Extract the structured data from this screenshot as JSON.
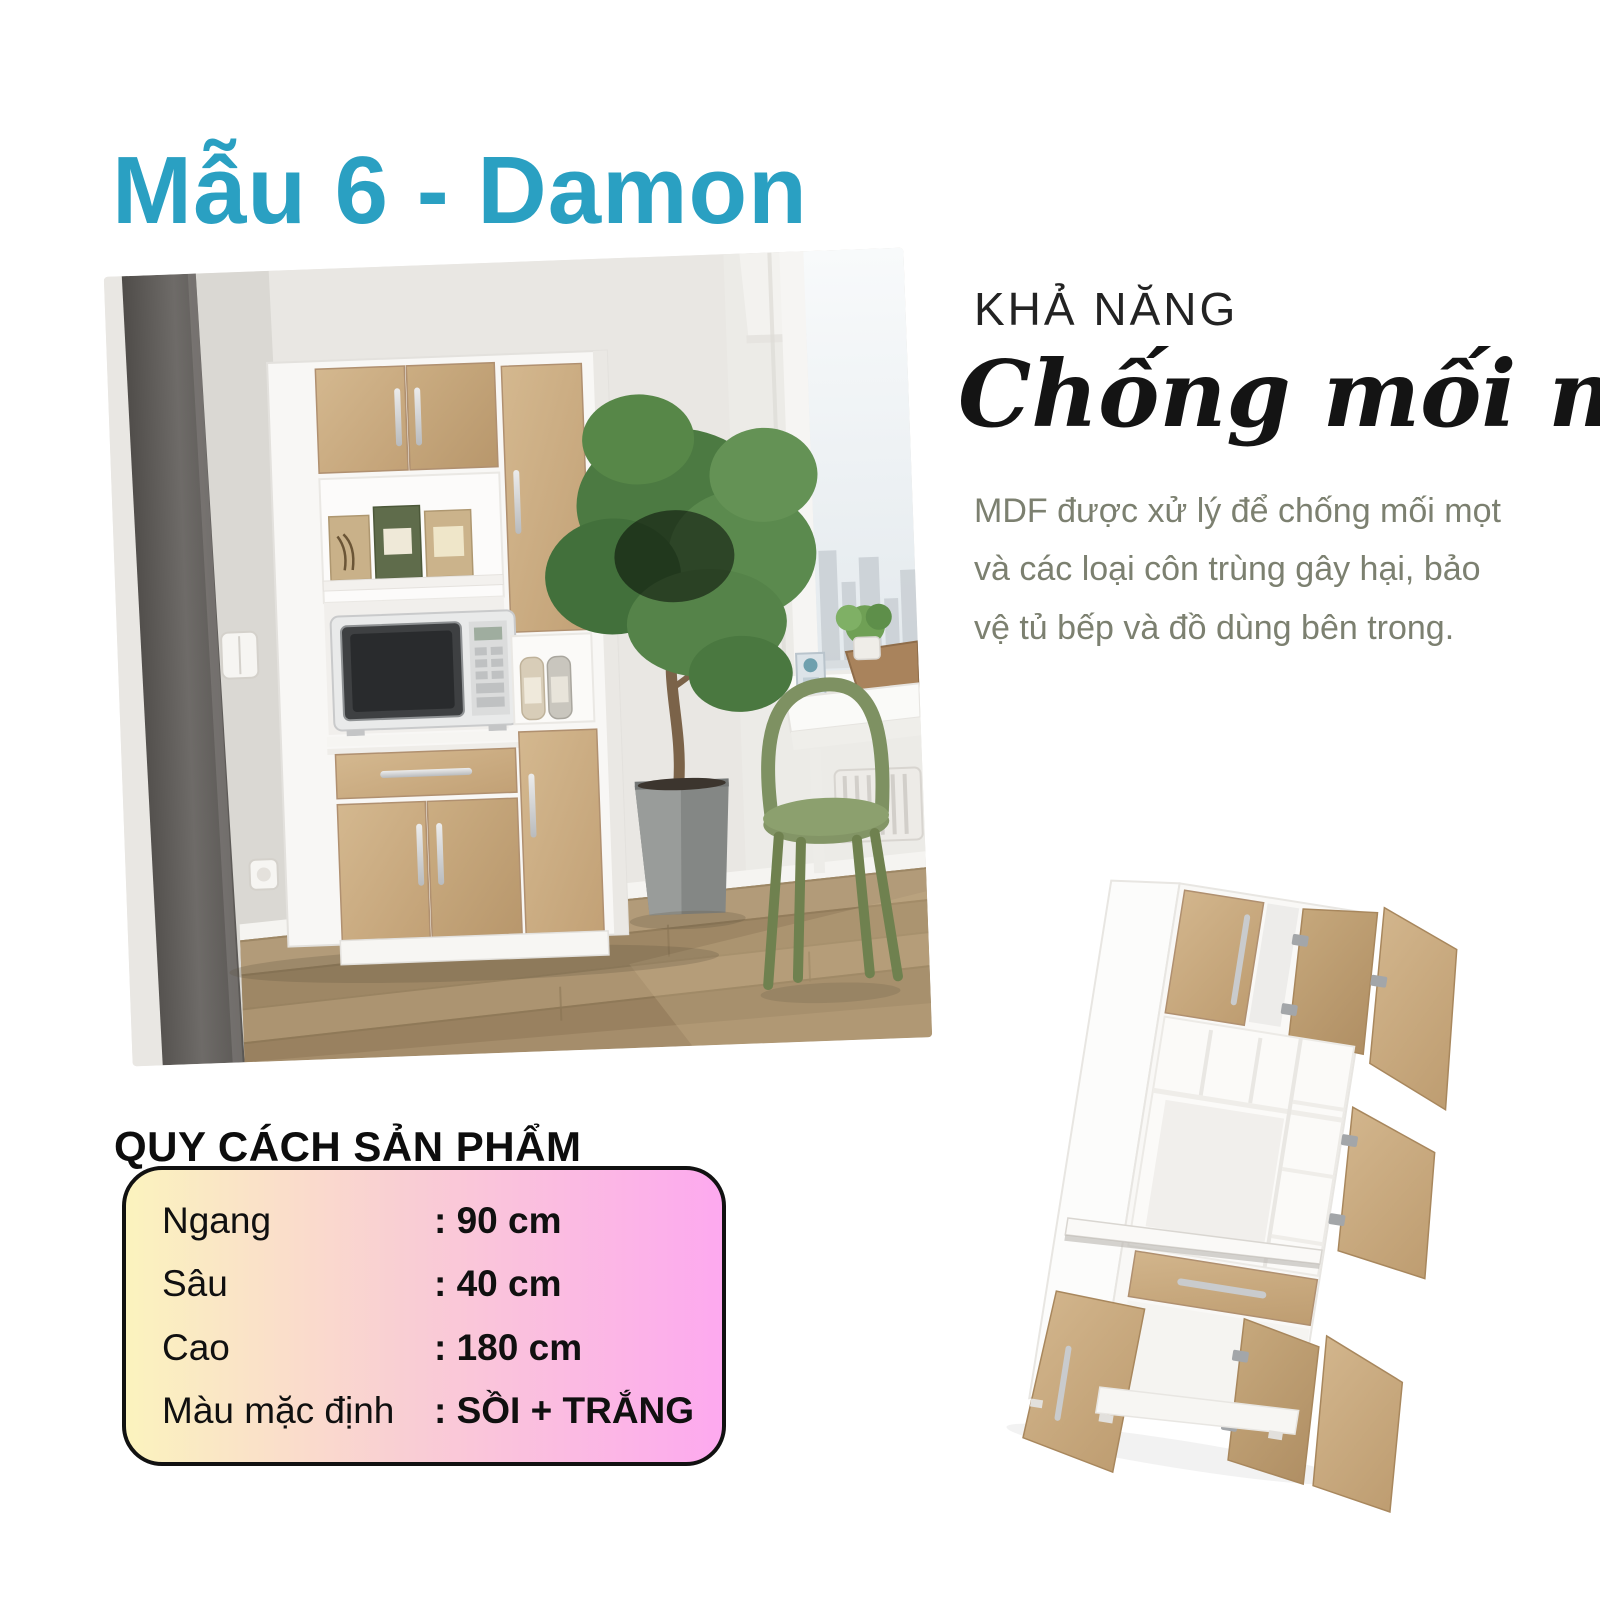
{
  "title": "Mẫu 6 - Damon",
  "feature": {
    "kicker": "KHẢ NĂNG",
    "headline": "Chống mối mọt",
    "body": "MDF được xử lý để chống mối mọt và các loại côn trùng gây hại, bảo vệ tủ bếp và đồ dùng bên trong."
  },
  "specs": {
    "heading": "QUY CÁCH SẢN PHẨM",
    "rows": [
      {
        "label": "Ngang",
        "value": ": 90 cm"
      },
      {
        "label": "Sâu",
        "value": ": 40 cm"
      },
      {
        "label": "Cao",
        "value": ": 180 cm"
      },
      {
        "label": "Màu mặc định",
        "value": ": SỒI + TRẮNG"
      }
    ]
  },
  "colors": {
    "accent_teal": "#2AA0C2",
    "heading_text": "#141414",
    "body_text": "#7C8070",
    "card_border": "#111111",
    "card_gradient_left": "#FBF3BE",
    "card_gradient_mid": "#F9CDD4",
    "card_gradient_right": "#FDA9EF",
    "oak_wood": "#C8A97E",
    "cabinet_white": "#F8F7F5",
    "chair_green": "#6E8150",
    "floor_wood": "#A58D6B"
  }
}
